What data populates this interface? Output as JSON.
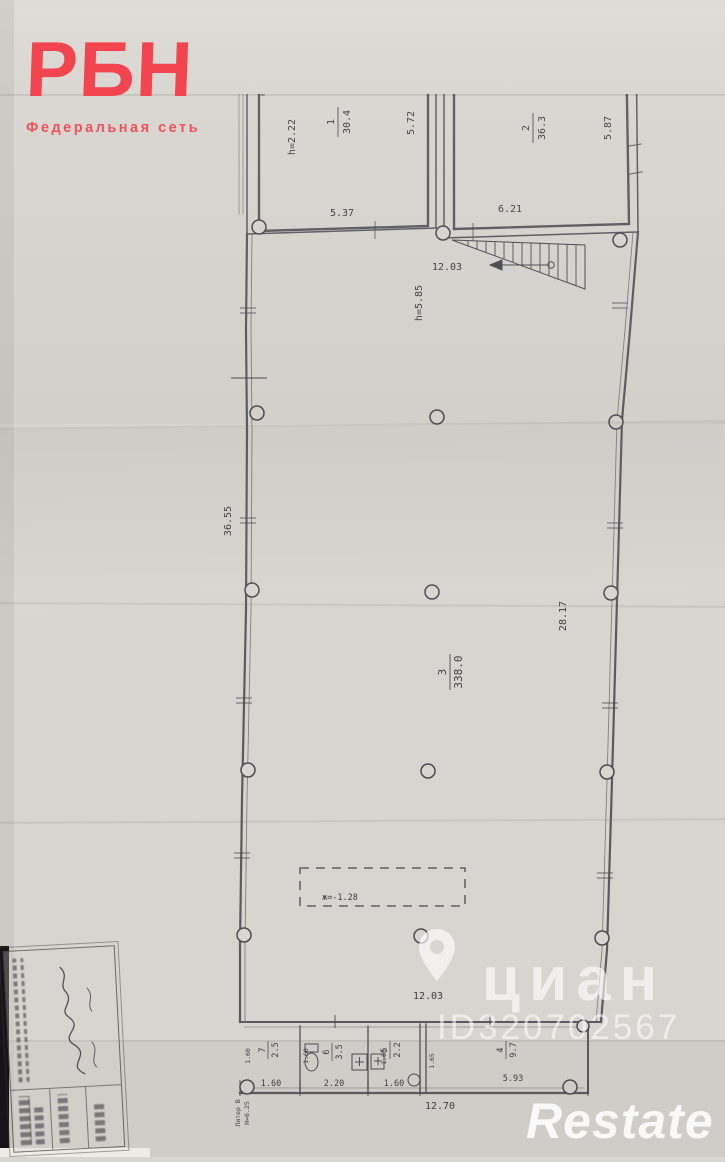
{
  "brand": {
    "logo": "РБН",
    "tagline": "Федеральная сеть"
  },
  "watermark": {
    "cian": "циан",
    "cian_id": "ID320702567",
    "restate": "Restate"
  },
  "plan": {
    "rooms": [
      {
        "number": "1",
        "area": "30.4"
      },
      {
        "number": "2",
        "area": "36.3"
      },
      {
        "number": "3",
        "area": "338.0"
      },
      {
        "number": "4",
        "area": "9.7"
      },
      {
        "number": "5",
        "area": "2.2"
      },
      {
        "number": "6",
        "area": "3.5"
      },
      {
        "number": "7",
        "area": "2.5"
      }
    ],
    "dims": {
      "r1_width_bottom": "5.37",
      "r1_height_right": "5.72",
      "r1_ceiling": "h=2.22",
      "r2_width_bottom": "6.21",
      "r2_height_right": "5.87",
      "r2_duct": "d=30см",
      "niche_1": "0.56",
      "niche_2": "0.28",
      "niche_3": "0.34",
      "niche_4": "0.54",
      "hall_width_top": "12.03",
      "hall_ceiling": "h=5.85",
      "wall_left": "36.55",
      "wall_right": "28.17",
      "pit_mark": "ж=-1.28",
      "hall_width_bottom": "12.03",
      "bottom_overall": "12.70",
      "r7_width": "1.60",
      "r6_width": "2.20",
      "r5_width": "1.60",
      "r4_width": "5.93",
      "r7_depth": "1.60",
      "r6_depth": "1.60",
      "r5_depth": "1.60",
      "r45_wall": "1.65",
      "liter": "Литер В",
      "liter_height": "Н=6.25"
    }
  }
}
